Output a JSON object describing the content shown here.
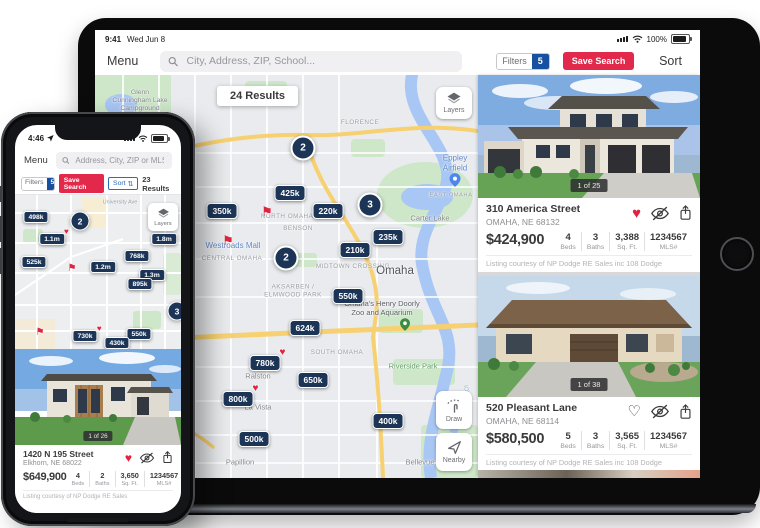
{
  "icons": {
    "heart": "♥",
    "heart_outline": "♡",
    "flag": "⚑",
    "sort_arrows": "⇅"
  },
  "ipad": {
    "status": {
      "time": "9:41",
      "date": "Wed Jun 8",
      "battery_pct": "100%"
    },
    "toolbar": {
      "menu": "Menu",
      "search_placeholder": "City, Address, ZIP, School...",
      "filters": "Filters",
      "filters_count": "5",
      "save_search": "Save Search",
      "sort": "Sort"
    },
    "map": {
      "results": "24 Results",
      "layers": "Layers",
      "draw": "Draw",
      "nearby": "Nearby",
      "clusters": [
        {
          "count": "2"
        },
        {
          "count": "3"
        },
        {
          "count": "2"
        }
      ],
      "pins": [
        {
          "label": "425k",
          "favorite": false
        },
        {
          "label": "350k",
          "favorite": false
        },
        {
          "label": "220k",
          "favorite": false
        },
        {
          "label": "235k",
          "favorite": false
        },
        {
          "label": "210k",
          "favorite": false
        },
        {
          "label": "550k",
          "favorite": false
        },
        {
          "label": "624k",
          "favorite": false
        },
        {
          "label": "780k",
          "favorite": true
        },
        {
          "label": "650k",
          "favorite": false
        },
        {
          "label": "800k",
          "favorite": true
        },
        {
          "label": "400k",
          "favorite": false
        },
        {
          "label": "500k",
          "favorite": false
        }
      ],
      "labels": [
        {
          "text": "Glenn Cunningham Lake Campground"
        },
        {
          "text": "FLORENCE"
        },
        {
          "text": "Eppley Airfield"
        },
        {
          "text": "EAST OMAHA"
        },
        {
          "text": "Carter Lake"
        },
        {
          "text": "NORTH OMAHA"
        },
        {
          "text": "BENSON"
        },
        {
          "text": "Westroads Mall"
        },
        {
          "text": "CENTRAL OMAHA"
        },
        {
          "text": "MIDTOWN CROSSING"
        },
        {
          "text": "Omaha"
        },
        {
          "text": "AKSARBEN / ELMWOOD PARK"
        },
        {
          "text": "Omaha's Henry Doorly Zoo and Aquarium"
        },
        {
          "text": "SOUTH OMAHA"
        },
        {
          "text": "Ralston"
        },
        {
          "text": "Riverside Park"
        },
        {
          "text": "La Vista"
        },
        {
          "text": "Papillion"
        },
        {
          "text": "Bellevue"
        },
        {
          "text": "IOWA"
        }
      ]
    },
    "cards": [
      {
        "photo_badge": "1 of 25",
        "address": "310 America Street",
        "city_state_zip": "OMAHA, NE 68132",
        "price": "$424,900",
        "favorited": true,
        "stats": [
          {
            "value": "4",
            "label": "Beds"
          },
          {
            "value": "3",
            "label": "Baths"
          },
          {
            "value": "3,388",
            "label": "Sq. Ft."
          },
          {
            "value": "1234567",
            "label": "MLS#"
          }
        ],
        "courtesy": "Listing courtesy of NP Dodge RE Sales inc 108 Dodge"
      },
      {
        "photo_badge": "1 of 38",
        "address": "520 Pleasant Lane",
        "city_state_zip": "OMAHA, NE 68114",
        "price": "$580,500",
        "favorited": false,
        "stats": [
          {
            "value": "5",
            "label": "Beds"
          },
          {
            "value": "3",
            "label": "Baths"
          },
          {
            "value": "3,565",
            "label": "Sq. Ft."
          },
          {
            "value": "1234567",
            "label": "MLS#"
          }
        ],
        "courtesy": "Listing courtesy of NP Dodge RE Sales inc 108 Dodge"
      }
    ]
  },
  "iphone": {
    "status": {
      "time": "4:46"
    },
    "toolbar": {
      "menu": "Menu",
      "search_placeholder": "Address, City, ZIP or MLS"
    },
    "filter_row": {
      "filters": "Filters",
      "filters_count": "5",
      "save_search": "Save Search",
      "sort": "Sort",
      "results": "23 Results"
    },
    "map": {
      "layers": "Layers",
      "street_label": "University Ave",
      "clusters": [
        {
          "count": "2"
        },
        {
          "count": "3"
        }
      ],
      "pins": [
        {
          "label": "498k",
          "favorite": false
        },
        {
          "label": "1.1m",
          "favorite": true
        },
        {
          "label": "1.8m",
          "favorite": false
        },
        {
          "label": "768k",
          "favorite": false
        },
        {
          "label": "525k",
          "favorite": false
        },
        {
          "label": "1.2m",
          "favorite": false
        },
        {
          "label": "1.3m",
          "favorite": false
        },
        {
          "label": "895k",
          "favorite": false
        },
        {
          "label": "730k",
          "favorite": true
        },
        {
          "label": "550k",
          "favorite": false
        },
        {
          "label": "430k",
          "favorite": false
        }
      ]
    },
    "card": {
      "photo_badge": "1 of 26",
      "address": "1420 N 195 Street",
      "city_state_zip": "Elkhorn, NE 68022",
      "price": "$649,900",
      "favorited": true,
      "stats": [
        {
          "value": "4",
          "label": "Beds"
        },
        {
          "value": "2",
          "label": "Baths"
        },
        {
          "value": "3,650",
          "label": "Sq. Ft."
        },
        {
          "value": "1234567",
          "label": "MLS#"
        }
      ],
      "courtesy": "Listing courtesy of NP Dodge RE Sales"
    }
  }
}
